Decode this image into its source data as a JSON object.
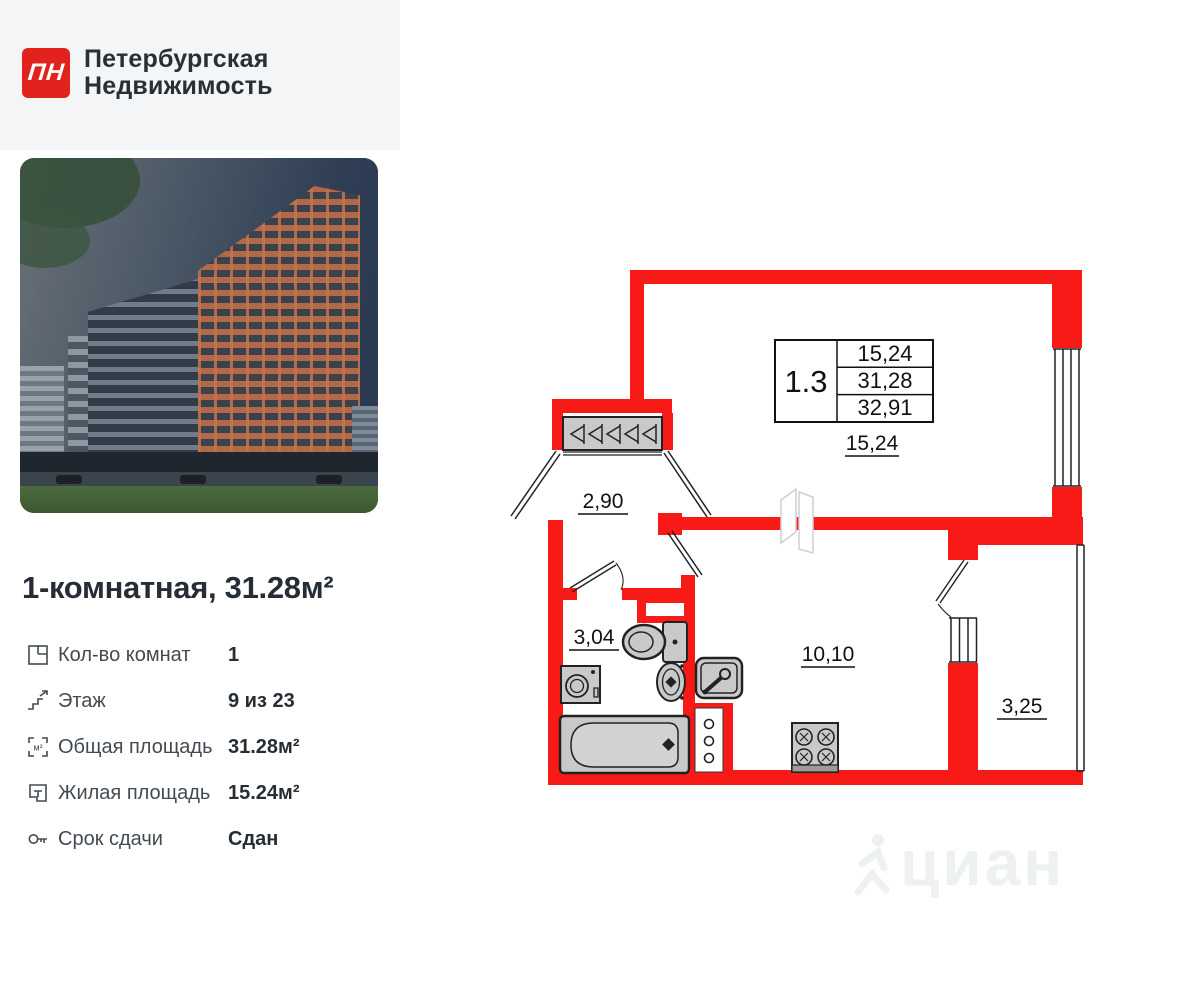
{
  "brand": {
    "logo_mark": "ПН",
    "name_line1": "Петербургская",
    "name_line2": "Недвижимость"
  },
  "listing": {
    "title": "1-комнатная, 31.28м²"
  },
  "specs": [
    {
      "label": "Кол-во комнат",
      "value": "1"
    },
    {
      "label": "Этаж",
      "value": "9 из 23"
    },
    {
      "label": "Общая площадь",
      "value": "31.28м²"
    },
    {
      "label": "Жилая площадь",
      "value": "15.24м²"
    },
    {
      "label": "Срок сдачи",
      "value": "Сдан"
    }
  ],
  "plan": {
    "unit_table": {
      "unit": "1.3",
      "living_area": "15,24",
      "total_area": "31,28",
      "total_with_balcony": "32,91"
    },
    "rooms": {
      "living": "15,24",
      "hallway": "2,90",
      "bathroom": "3,04",
      "kitchen": "10,10",
      "balcony": "3,25"
    }
  },
  "watermark": "циан",
  "colors": {
    "wall_red": "#f81a16",
    "logo_red": "#e2231d",
    "text_dark": "#262d34",
    "text_gray": "#434a52",
    "fixture_gray": "#c9c9c9"
  }
}
